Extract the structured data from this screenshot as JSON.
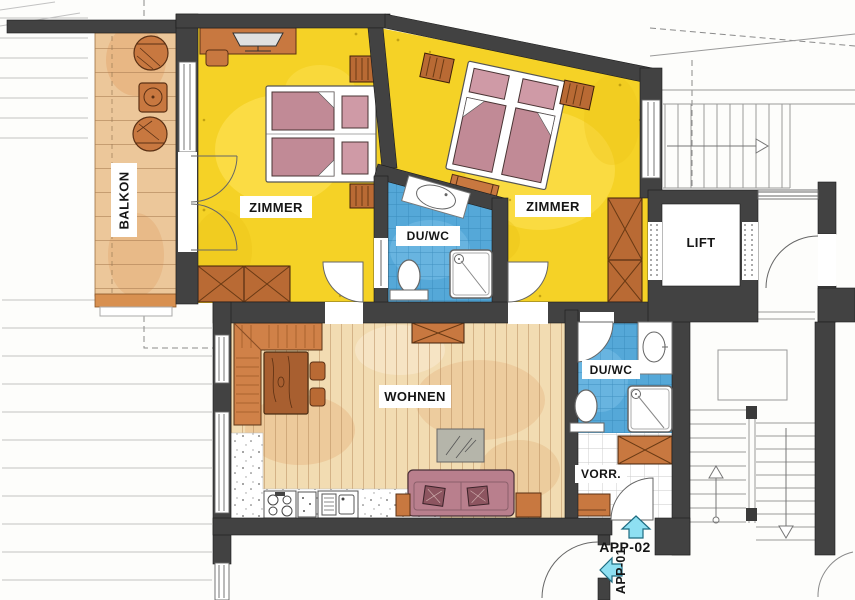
{
  "rooms": {
    "balcony": "BALKON",
    "bedroom_left": "ZIMMER",
    "bedroom_right": "ZIMMER",
    "bath_between_bedrooms": "DU/WC",
    "bath_at_hall": "DU/WC",
    "lift": "LIFT",
    "living_room": "WOHNEN",
    "hallway": "VORR."
  },
  "entrances": {
    "app02": "APP-02",
    "app01": "APP-01"
  },
  "colors": {
    "wall": "#424242",
    "bedroom_floor": "#f5d226",
    "bathroom_tile": "#55a8d8",
    "balcony_wood": "#ecc79a",
    "living_floor": "#f2dcb2",
    "furniture_wood": "#c87840",
    "bed_mattress": "#c18a96",
    "entry_arrow": "#8ee0f2"
  }
}
